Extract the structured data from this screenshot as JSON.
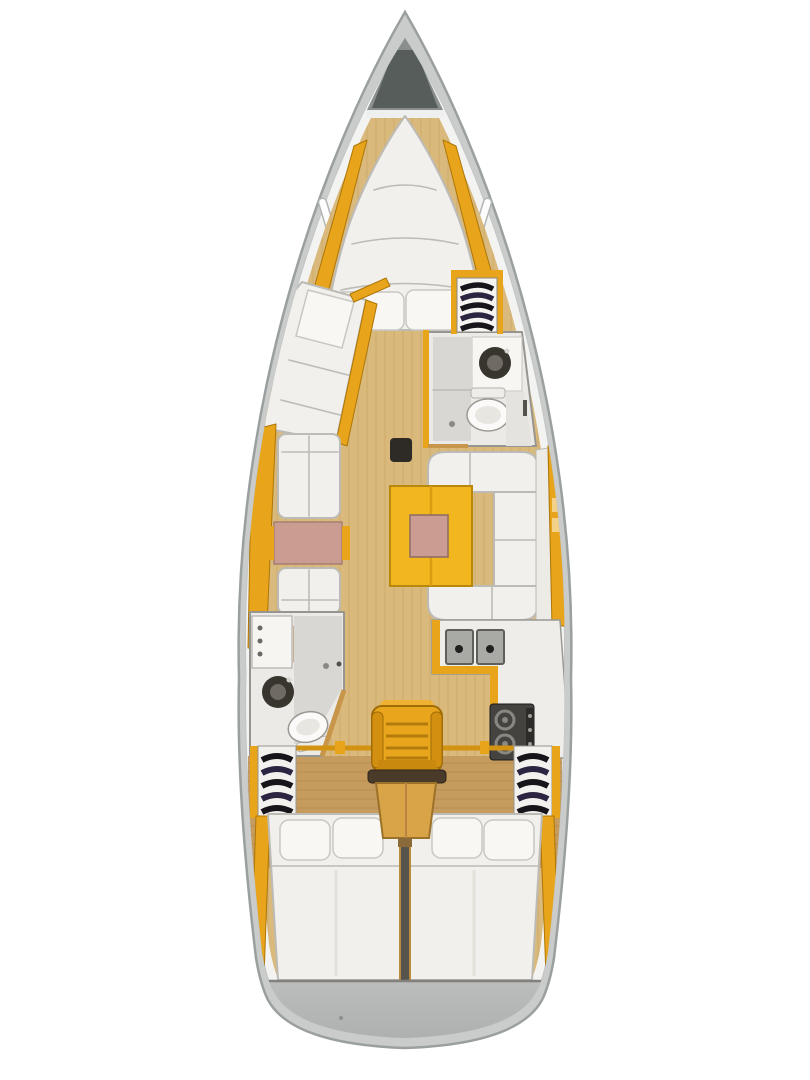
{
  "colors": {
    "hull_outer": "#c9cccb",
    "hull_edge": "#9aa09e",
    "deck_white": "#f3f4f2",
    "wood_light": "#d9b97c",
    "wood_grain": "#c8a263",
    "wood_aft": "#c59b5e",
    "wood_aft_grain": "#b0874a",
    "amber": "#e8a41a",
    "amber_dark": "#ad7607",
    "table_yellow": "#f2b71f",
    "table_edge": "#b9880a",
    "pink": "#cb9c91",
    "cushion": "#f2f0ec",
    "cushion_edge": "#bdbbb5",
    "fixture_dark": "#38342e",
    "room_wall": "#97958f",
    "shower_gray": "#d8d7d3",
    "hanger_black": "#17141a",
    "hanger_tint": "#2c2440",
    "anchor_dark": "#575d5a",
    "anchor_mid": "#8a8f8d",
    "transom": "#bcbebd",
    "transom_edge": "#83817d",
    "stove_dark": "#454340",
    "burner": "#8a8781",
    "sink_steel": "#a9a9a6",
    "steps_wood": "#e9a61d",
    "steps_dark_tread": "#4a3a29",
    "bed_shade": "#e4e1da"
  }
}
